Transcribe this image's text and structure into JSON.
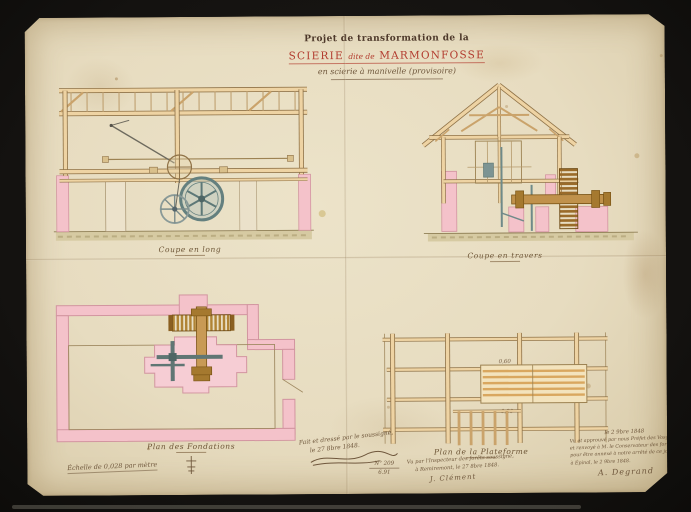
{
  "palette": {
    "mount_black": "#141210",
    "paper": "#e7dcc0",
    "title_red": "#b23b2e",
    "ink_dark": "#4d382a",
    "ink_cursive": "#6f573c",
    "timber": "#eed3a3",
    "timber_outline": "#8f7247",
    "masonry_pink": "#f4c2ca",
    "masonry_outline": "#d295a0",
    "wheel_grey": "#64807f",
    "gear_brown": "#a5792f",
    "ground_olive": "#8f7f55"
  },
  "title": {
    "line1": "Projet de transformation de la",
    "line2_main1": "SCIERIE",
    "line2_small": "dite de",
    "line2_main2": "MARMONFOSSE",
    "line3": "en scierie à manivelle (provisoire)"
  },
  "drawings": {
    "coupe_long": {
      "caption": "Coupe en long"
    },
    "coupe_travers": {
      "caption": "Coupe en travers"
    },
    "plan_fondations": {
      "caption": "Plan des Fondations"
    },
    "plan_plateforme": {
      "caption": "Plan de la Plateforme"
    },
    "dim_top": "0,60",
    "dim_bottom": "0,30"
  },
  "footer": {
    "scale_note": "Échelle de 0,028 par mètre",
    "made_line1": "Fait et dressé par le soussigné,",
    "made_line2": "le 27 8bre 1848.",
    "doc_no_top": "N° 209",
    "doc_no_bottom": "6.91",
    "vu_line1": "Vu par l'Inspecteur des forêts soussigné,",
    "vu_line2": "à Remiremont, le 27 8bre 1848.",
    "vu_sig": "J. Clément",
    "approval_head": "le 2 9bre 1848",
    "approval_line1": "Vu et approuvé par nous Préfet des Vosges,",
    "approval_line2": "et renvoyé à M. le Conservateur des forêts",
    "approval_line3": "pour être annexé à notre arrêté de ce jour,",
    "approval_line4": "à Épinal, le 2 9bre 1848.",
    "approval_sig": "A. Degrand"
  }
}
